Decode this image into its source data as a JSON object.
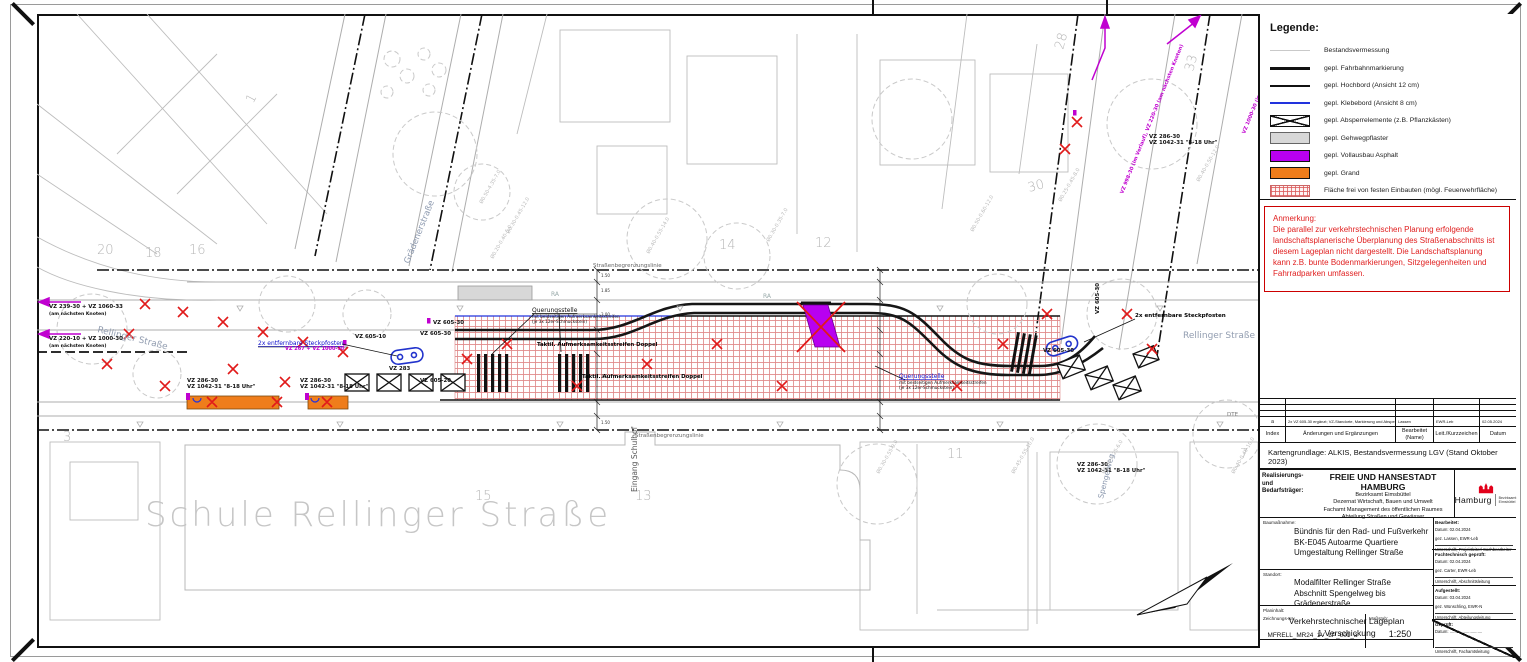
{
  "legend": {
    "title": "Legende:",
    "items": [
      {
        "label": "Bestandsvermessung"
      },
      {
        "label": "gepl. Fahrbahnmarkierung"
      },
      {
        "label": "gepl. Hochbord (Ansicht 12 cm)"
      },
      {
        "label": "gepl. Klebebord (Ansicht 8 cm)"
      },
      {
        "label": "gepl. Absperrelemente (z.B. Pflanzkästen)"
      },
      {
        "label": "gepl. Gehwegpflaster"
      },
      {
        "label": "gepl. Vollausbau Asphalt"
      },
      {
        "label": "gepl. Grand"
      },
      {
        "label": "Fläche frei von festen Einbauten (mögl. Feuerwehrfläche)"
      }
    ]
  },
  "note": {
    "title": "Anmerkung:",
    "text": "Die parallel zur verkehrstechnischen Planung erfolgende landschaftsplanerische Überplanung des Straßenabschnitts ist diesem Lageplan nicht dargestellt. Die Landschaftsplanung kann z.B. bunte Bodenmarkierungen, Sitzgelegenheiten und Fahrradparken umfassen."
  },
  "revision": {
    "entry": {
      "index": "a",
      "changes": "2x VZ 605-30 ergänzt; VZ-Standorte, Markierung und Absperrelemente angepasst",
      "bearbeitet": "Lassen",
      "kurz": "EWR-Leb",
      "datum": "02.05.2024"
    },
    "headers": {
      "index": "Index",
      "changes": "Änderungen und Ergänzungen",
      "bearbeitet1": "Bearbeitet",
      "bearbeitet2": "(Name)",
      "kurz": "Leit./Kurzzeichen",
      "datum": "Datum"
    }
  },
  "map_base": "Kartengrundlage: ALKIS, Bestandsvermessung LGV (Stand Oktober 2023)",
  "title_block": {
    "client_label_1": "Realisierungs-",
    "client_label_2": "und",
    "client_label_3": "Bedarfsträger:",
    "city": "FREIE UND HANSESTADT HAMBURG",
    "dept_1": "Bezirksamt Eimsbüttel",
    "dept_2": "Dezernat Wirtschaft, Bauen und Umwelt",
    "dept_3": "Fachamt Management des öffentlichen Raumes",
    "dept_4": "Abteilung Straßen und Gewässer",
    "logo_text": "Hamburg",
    "logo_sub1": "Bezirksamt",
    "logo_sub2": "Eimsbüttel",
    "project_label": "Baumaßnahme:",
    "project_1": "Bündnis für den Rad- und Fußverkehr",
    "project_2": "BK-E045 Autoarme Quartiere",
    "project_3": "Umgestaltung Rellinger Straße",
    "location_label": "Standort:",
    "location_1": "Modalfilter Rellinger Straße",
    "location_2": "Abschnitt Spengelweg bis Grädenerstraße",
    "content_label": "Planinhalt:",
    "content_1": "Verkehrstechnischer Lageplan",
    "content_2": "1.Verschickung",
    "drawing_no_label": "Zeichnungs-Nr.:",
    "drawing_no": "MFRELL_MR24_1V_LP_001_a",
    "scale_label": "Maßstab:",
    "scale": "1:250",
    "sign_boxes": [
      {
        "title": "Bearbeitet:",
        "date_label": "Datum:",
        "date": "02.04.2024",
        "gez": "gez. Lassen, EWR-Leb",
        "sig": "Unterschrift, Projektleiter/ Sachbearbeiter"
      },
      {
        "title": "Fachtechnisch geprüft:",
        "date_label": "Datum:",
        "date": "02.04.2024",
        "gez": "gez. Carter, EWR-Leb",
        "sig": "Unterschrift, Abschnittsleitung"
      },
      {
        "title": "Aufgestellt:",
        "date_label": "Datum:",
        "date": "03.04.2024",
        "gez": "gez. Wünschling, EWR-N",
        "sig": "Unterschrift, Abteilungsleitung"
      },
      {
        "title": "Geprüft:",
        "date_label": "Datum:",
        "date": "............................",
        "gez": "",
        "sig": "Unterschrift, Fachamtsleitung"
      }
    ]
  },
  "plan": {
    "labels": {
      "school": "Schule Rellinger Straße",
      "rellinger": "Rellinger Straße",
      "graedener": "Grädenerstraße",
      "spengelweg": "Spengelweg",
      "eingang": "Eingang Schulhof",
      "sbl": "Straßenbegrenzungslinie",
      "querung_title": "Querungsstelle",
      "querung_l2": "mit beidseitigen Aufmerksamkeitsstreifen",
      "querung_l3": "(je 3x 12er-Schmuckstein)",
      "taktil": "Taktil. Aufmerksamkeitsstreifen Doppel",
      "steckpfosten": "2x entfernbare Steckpfosten",
      "vz_a1": "VZ 239-30 + VZ 1060-33",
      "vz_a2": "(am nächsten Knoten)",
      "vz_b1": "VZ 220-10 + VZ 1000-30",
      "vz_286": "VZ 286-30",
      "vz_1042": "VZ 1042-31 \"8-18 Uhr\"",
      "vz_267": "VZ 267 + VZ 1000-30",
      "vz_605_10": "VZ 605-10",
      "vz_605_20": "VZ 605-20",
      "vz_605_30": "VZ 605-30",
      "vz_283": "VZ 283",
      "vz_diag_1": "VZ 1000-30 (im Verlauf), VZ 239-30 (am nächsten Knoten)",
      "vz_diag_2": "VZ 998-30 (im Verlauf), VZ 220-30 (am nächsten Knoten)",
      "ra": "RA",
      "dte": "DTE"
    },
    "parcels": [
      "20",
      "18",
      "16",
      "1",
      "3",
      "14",
      "12",
      "28",
      "30",
      "33",
      "15",
      "13",
      "11",
      "7"
    ],
    "trees": [
      "Ø0.50-4.35-7.0",
      "Ø0.30-0.45-12.0",
      "Ø0.20-0.40-5.0",
      "Ø0.40-0.55-14.0",
      "Ø0.30-0.35-7.0",
      "Ø0.50-0.60-12.0",
      "Ø0.25-0.45-8.0",
      "Ø0.40-0.50-12.0",
      "Ø0.30-0.55-9.0",
      "Ø0.45-0.55-10.0",
      "Ø0.30-0.25-6.0",
      "Ø0.40-0.45-10.0"
    ],
    "dims": [
      "1.50",
      "1.85",
      "3.00",
      "2.50",
      "1.50"
    ]
  },
  "colors": {
    "asphalt_purple": "#b800f0",
    "grand_orange": "#ef7d1b",
    "fire_hatch_red": "#dc5a5a",
    "klebebord_blue": "#2233dd",
    "removal_red": "#e11a1a",
    "sign_magenta": "#c000d0",
    "note_red": "#cc0000",
    "survey_gray": "#b8b8b8"
  }
}
